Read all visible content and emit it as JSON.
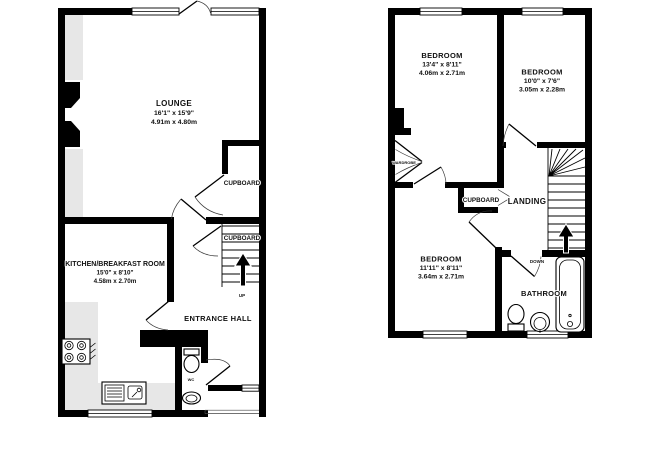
{
  "ground_floor": {
    "lounge": {
      "name": "LOUNGE",
      "size_imperial": "16'1\" x 15'9\"",
      "size_metric": "4.91m x 4.80m"
    },
    "kitchen": {
      "name": "KITCHEN/BREAKFAST ROOM",
      "size_imperial": "15'0\" x 8'10\"",
      "size_metric": "4.58m x 2.70m"
    },
    "entrance_hall": {
      "name": "ENTRANCE HALL"
    },
    "cupboard_upper": {
      "name": "CUPBOARD"
    },
    "cupboard_under_stairs": {
      "name": "CUPBOARD"
    },
    "wc": {
      "name": "WC"
    },
    "stairs": {
      "direction_label": "UP"
    }
  },
  "first_floor": {
    "bedroom_1": {
      "name": "BEDROOM",
      "size_imperial": "13'4\" x 8'11\"",
      "size_metric": "4.06m x 2.71m"
    },
    "bedroom_2": {
      "name": "BEDROOM",
      "size_imperial": "10'0\" x 7'6\"",
      "size_metric": "3.05m x 2.28m"
    },
    "bedroom_3": {
      "name": "BEDROOM",
      "size_imperial": "11'11\" x 8'11\"",
      "size_metric": "3.64m x 2.71m"
    },
    "landing": {
      "name": "LANDING"
    },
    "cupboard": {
      "name": "CUPBOARD"
    },
    "bathroom": {
      "name": "BATHROOM"
    },
    "wardrobe": {
      "name": "WARDROBE"
    },
    "stairs": {
      "direction_label": "DOWN"
    }
  },
  "colors": {
    "wall": "#000000",
    "counter_fill": "#e7e7e7",
    "text": "#111111",
    "background": "#ffffff"
  }
}
